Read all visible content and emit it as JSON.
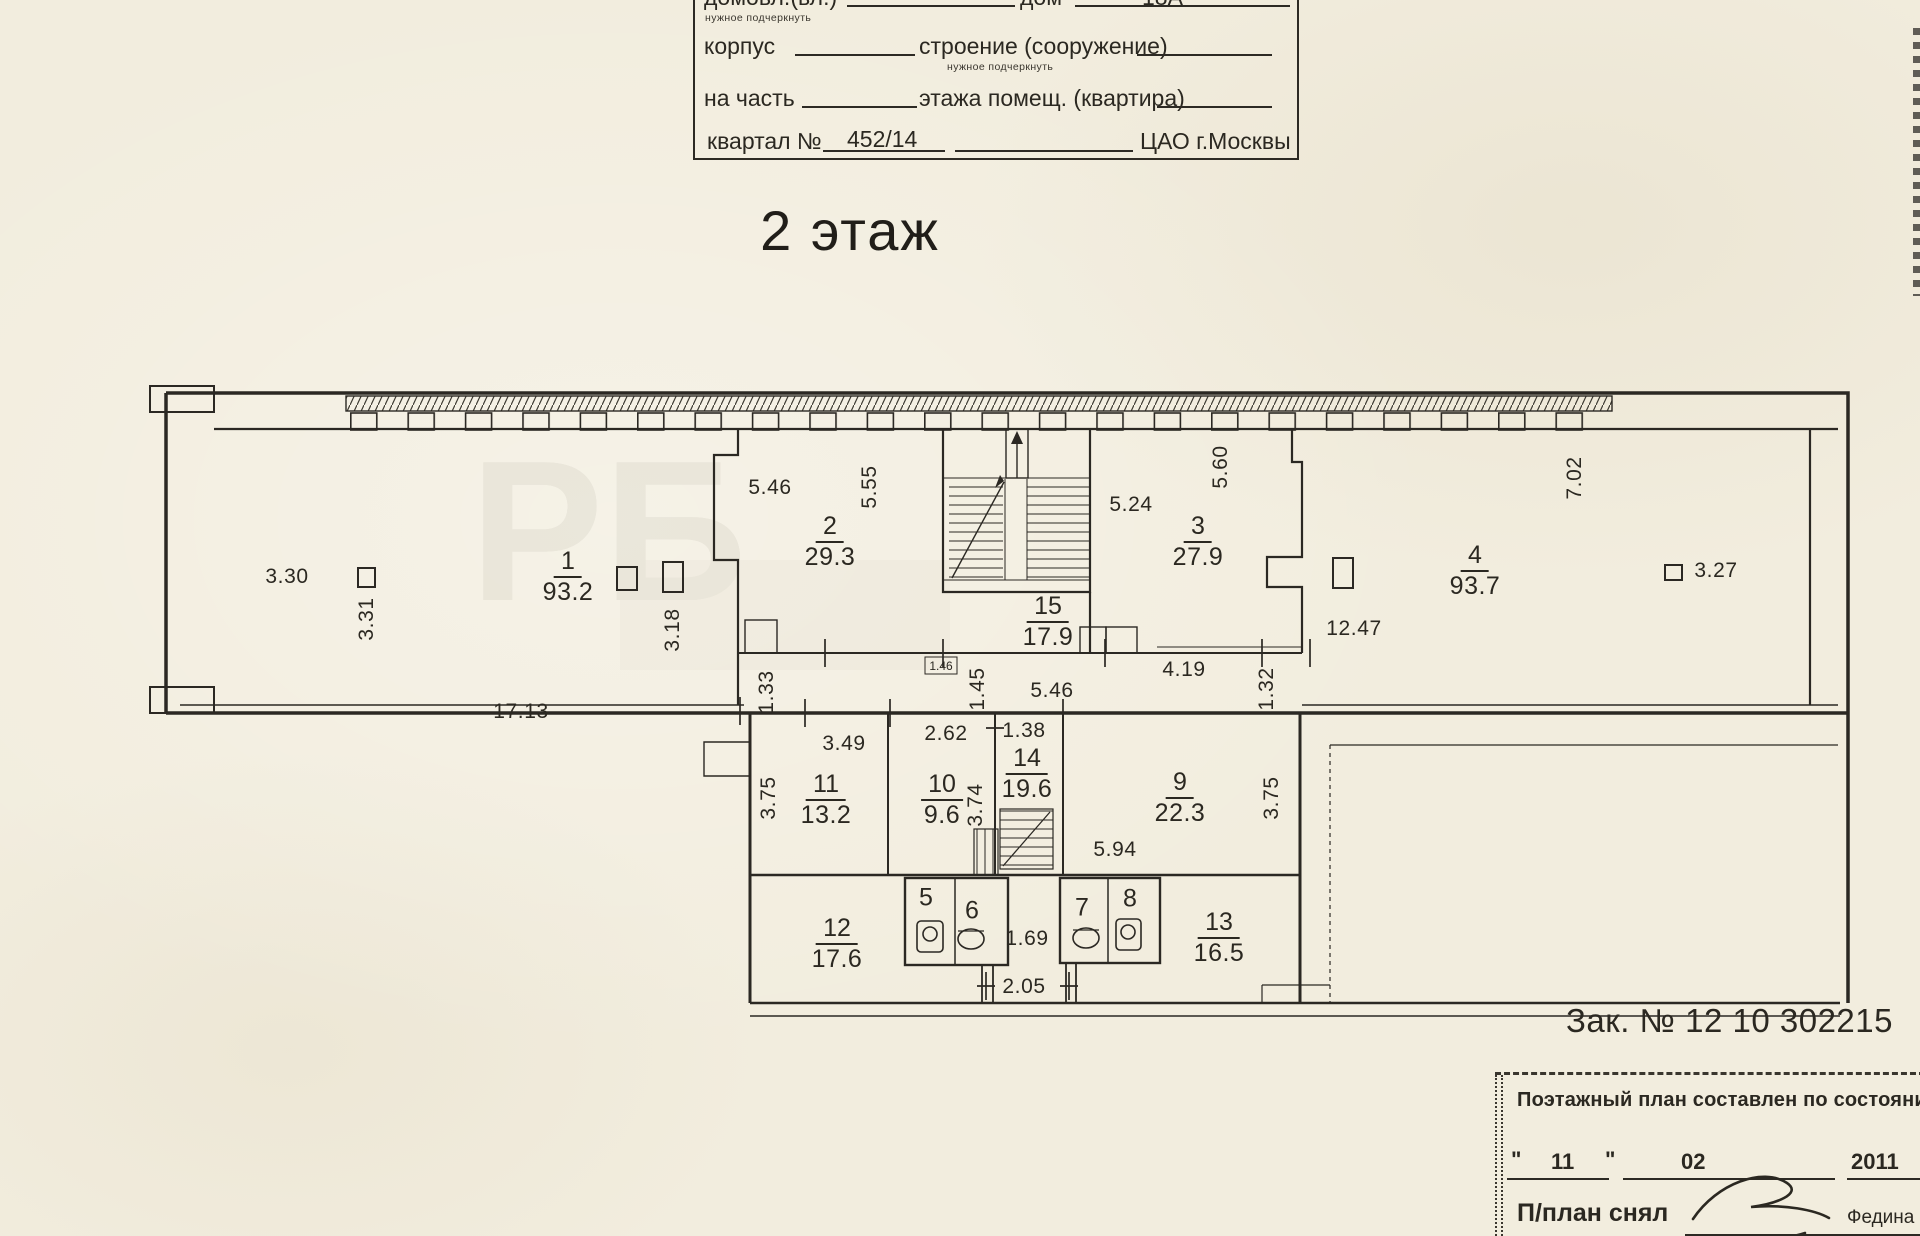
{
  "document": {
    "floor_title": "2 этаж",
    "order_number": "Зак. № 12 10 302215"
  },
  "header_form": {
    "line1_label1": "домовл.(вл.)",
    "line1_label2": "дом",
    "line1_value": "18А",
    "line1_note": "нужное подчеркнуть",
    "line2_label1": "корпус",
    "line2_label2": "строение (сооружение)",
    "line2_note": "нужное подчеркнуть",
    "line3_label1": "на часть",
    "line3_label2": "этажа помещ. (квартира)",
    "line4_label": "квартал №",
    "line4_value": "452/14",
    "line4_district": "ЦАО г.Москвы"
  },
  "footer_form": {
    "title": "Поэтажный план составлен по состоянию",
    "quote_open": "\"",
    "day": "11",
    "quote_close": "\"",
    "month": "02",
    "year": "2011",
    "surveyor_label": "П/план снял",
    "surveyor_name": "Федина Н"
  },
  "plan": {
    "watermark": "РБ",
    "rooms": [
      {
        "number": "1",
        "area": "93.2",
        "x": 568,
        "y": 577
      },
      {
        "number": "2",
        "area": "29.3",
        "x": 830,
        "y": 542
      },
      {
        "number": "3",
        "area": "27.9",
        "x": 1198,
        "y": 542
      },
      {
        "number": "4",
        "area": "93.7",
        "x": 1475,
        "y": 571
      },
      {
        "number": "15",
        "area": "17.9",
        "x": 1048,
        "y": 622
      },
      {
        "number": "11",
        "area": "13.2",
        "x": 826,
        "y": 800
      },
      {
        "number": "10",
        "area": "9.6",
        "x": 942,
        "y": 800
      },
      {
        "number": "14",
        "area": "19.6",
        "x": 1027,
        "y": 774
      },
      {
        "number": "9",
        "area": "22.3",
        "x": 1180,
        "y": 798
      },
      {
        "number": "12",
        "area": "17.6",
        "x": 837,
        "y": 944
      },
      {
        "number": "13",
        "area": "16.5",
        "x": 1219,
        "y": 938
      }
    ],
    "cells": [
      {
        "number": "5",
        "x": 926,
        "y": 898
      },
      {
        "number": "6",
        "x": 972,
        "y": 911
      },
      {
        "number": "7",
        "x": 1082,
        "y": 908
      },
      {
        "number": "8",
        "x": 1130,
        "y": 899
      }
    ],
    "dimensions": [
      {
        "text": "3.30",
        "x": 287,
        "y": 577
      },
      {
        "text": "3.31",
        "x": 367,
        "y": 619,
        "v": 1
      },
      {
        "text": "17.13",
        "x": 521,
        "y": 712
      },
      {
        "text": "3.18",
        "x": 673,
        "y": 630,
        "v": 1
      },
      {
        "text": "5.46",
        "x": 770,
        "y": 488
      },
      {
        "text": "5.55",
        "x": 870,
        "y": 487,
        "v": 1
      },
      {
        "text": "1.33",
        "x": 767,
        "y": 692,
        "v": 1
      },
      {
        "text": "1.45",
        "x": 978,
        "y": 689,
        "v": 1
      },
      {
        "text": "1.46",
        "x": 941,
        "y": 666,
        "sm": 1
      },
      {
        "text": "5.46",
        "x": 1052,
        "y": 691
      },
      {
        "text": "5.24",
        "x": 1131,
        "y": 505
      },
      {
        "text": "5.60",
        "x": 1221,
        "y": 467,
        "v": 1
      },
      {
        "text": "4.19",
        "x": 1184,
        "y": 670
      },
      {
        "text": "1.32",
        "x": 1267,
        "y": 689,
        "v": 1
      },
      {
        "text": "12.47",
        "x": 1354,
        "y": 629
      },
      {
        "text": "7.02",
        "x": 1575,
        "y": 478,
        "v": 1
      },
      {
        "text": "3.27",
        "x": 1716,
        "y": 571
      },
      {
        "text": "3.49",
        "x": 844,
        "y": 744
      },
      {
        "text": "2.62",
        "x": 946,
        "y": 734
      },
      {
        "text": "1.38",
        "x": 1024,
        "y": 731
      },
      {
        "text": "3.75",
        "x": 769,
        "y": 798,
        "v": 1
      },
      {
        "text": "3.74",
        "x": 976,
        "y": 805,
        "v": 1
      },
      {
        "text": "3.75",
        "x": 1272,
        "y": 798,
        "v": 1
      },
      {
        "text": "5.94",
        "x": 1115,
        "y": 850
      },
      {
        "text": "1.69",
        "x": 1027,
        "y": 939
      },
      {
        "text": "2.05",
        "x": 1024,
        "y": 987
      }
    ]
  }
}
